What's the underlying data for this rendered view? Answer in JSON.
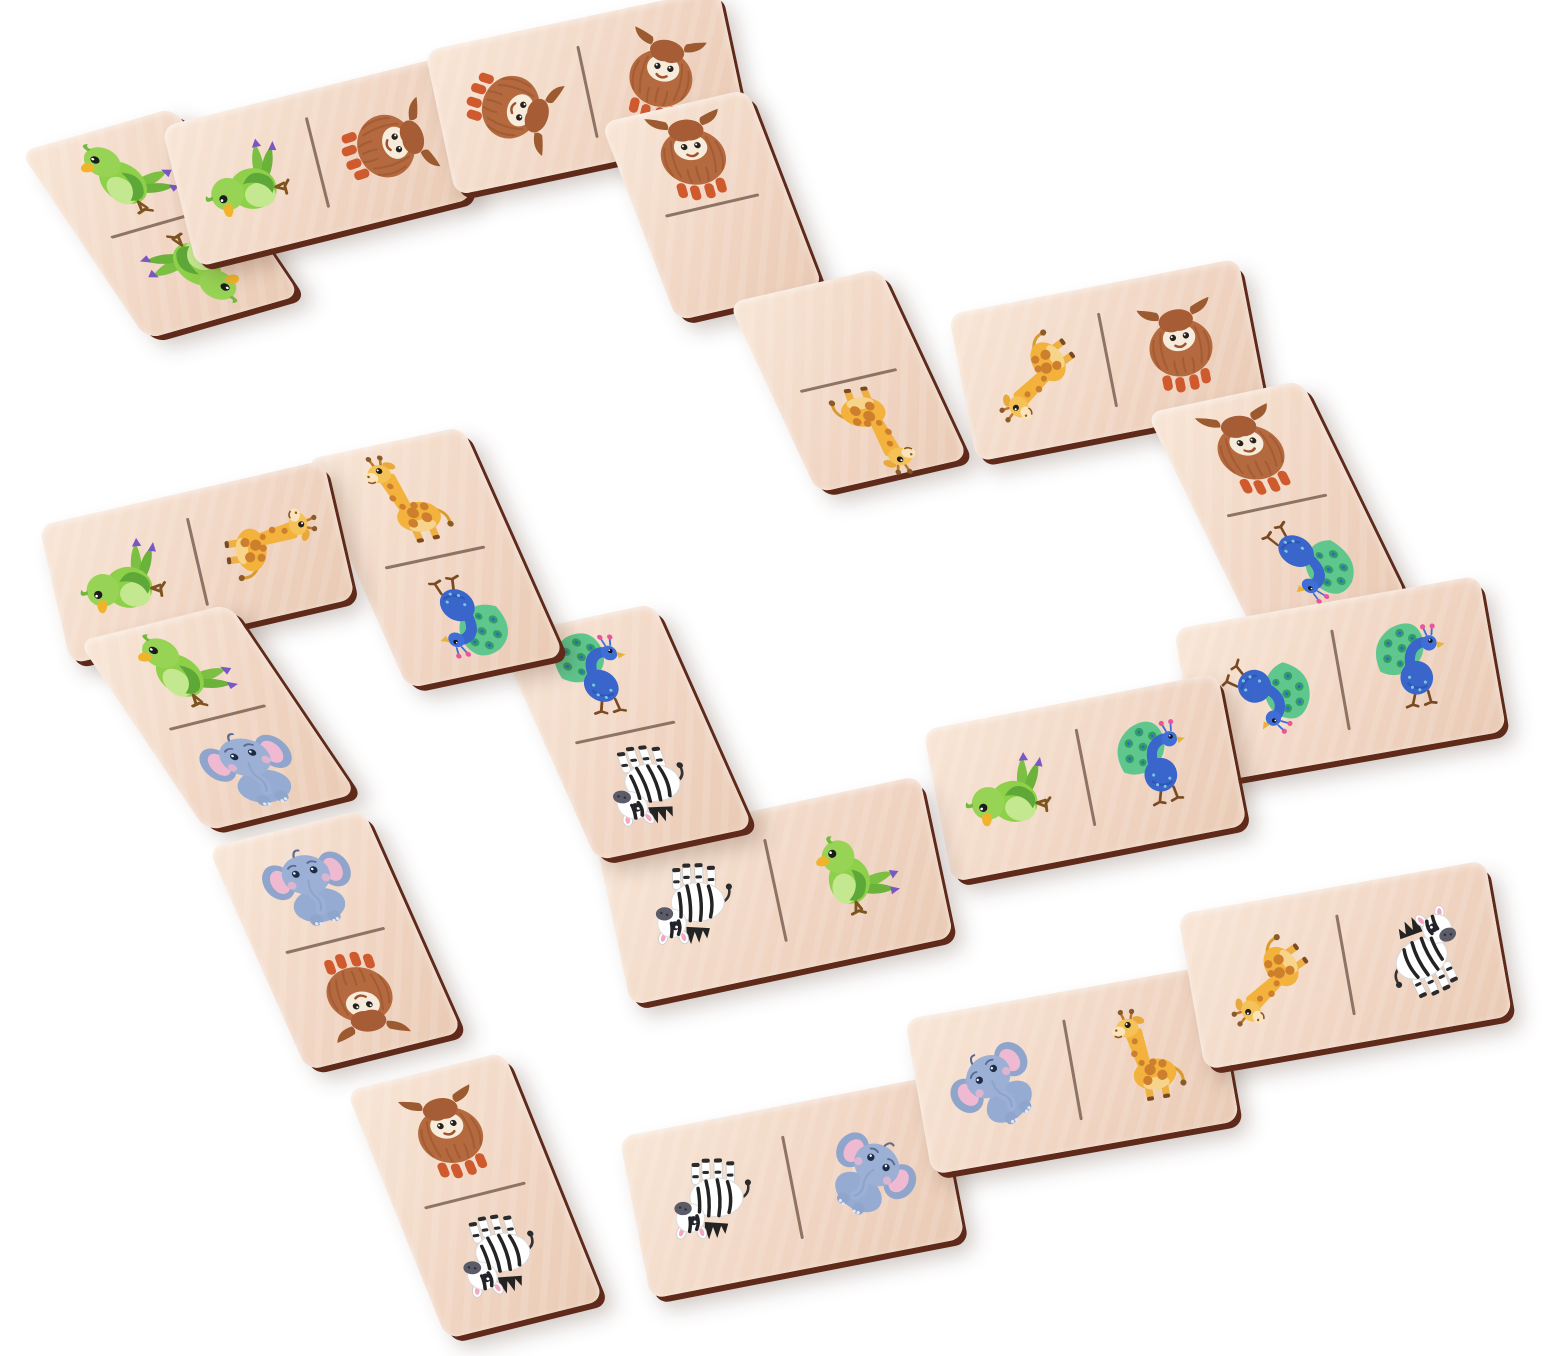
{
  "scene": {
    "subject": "wooden-animal-domino-chain",
    "background_color": "#ffffff",
    "tile_count": 19
  },
  "palette": {
    "bg": "#ffffff",
    "wood_light": "#f8e6d6",
    "wood": "#f1d6c4",
    "wood_shadow": "#e9cab4",
    "edge": "#5f2a1a",
    "divider": "#7d6152",
    "drop_shadow": "rgba(75,42,28,0.25)"
  },
  "animals": {
    "parrot": {
      "label": "Parrot",
      "colors": {
        "body": "#8ed049",
        "wing": "#5ea839",
        "belly": "#c4e88f",
        "beak": "#f0b42c",
        "tail_tip": "#7a58c4"
      }
    },
    "yak": {
      "label": "Yak",
      "colors": {
        "fur": "#b46a3e",
        "fur_dark": "#9a5530",
        "face": "#f7ecdc",
        "horns": "#9c5a30",
        "hooves": "#cf5a2e"
      }
    },
    "giraffe": {
      "label": "Giraffe",
      "colors": {
        "coat": "#f2b23c",
        "patches": "#cd7f2e",
        "muzzle": "#fbe3bb",
        "hooves": "#7a4a22"
      }
    },
    "peacock": {
      "label": "Peacock",
      "colors": {
        "body": "#3a66cc",
        "fan": "#5fc78e",
        "fan_spots": "#2f9f63",
        "crest": "#e8559a",
        "beak": "#e8b33c"
      }
    },
    "zebra": {
      "label": "Zebra",
      "colors": {
        "coat": "#ffffff",
        "stripes": "#232323",
        "muzzle": "#5c5c68",
        "ears": "#f4a8c0"
      }
    },
    "elephant": {
      "label": "Elephant",
      "colors": {
        "body": "#96abd2",
        "head": "#9cb0d6",
        "ear_inner": "#f0b9d2",
        "cheeks": "#edb6cf"
      }
    },
    "blank": {
      "label": "Blank"
    }
  },
  "tiles": [
    {
      "id": 1,
      "orientation": "vertical",
      "cx": 160,
      "cy": 223,
      "w": 160,
      "h": 215,
      "tilt": -16,
      "skew": 18,
      "halves": [
        {
          "animal": "parrot",
          "rotation": 0
        },
        {
          "animal": "parrot",
          "rotation": 180
        }
      ]
    },
    {
      "id": 2,
      "orientation": "horizontal",
      "cx": 317,
      "cy": 162,
      "w": 285,
      "h": 145,
      "tilt": -14,
      "skew": 0,
      "halves": [
        {
          "animal": "parrot",
          "rotation": -75
        },
        {
          "animal": "yak",
          "rotation": 85
        }
      ]
    },
    {
      "id": 3,
      "orientation": "horizontal",
      "cx": 587,
      "cy": 92,
      "w": 300,
      "h": 148,
      "tilt": -12,
      "skew": 0,
      "halves": [
        {
          "animal": "yak",
          "rotation": 120
        },
        {
          "animal": "yak",
          "rotation": 25
        }
      ]
    },
    {
      "id": 4,
      "orientation": "vertical",
      "cx": 712,
      "cy": 205,
      "w": 150,
      "h": 210,
      "tilt": -13,
      "skew": 8,
      "halves": [
        {
          "animal": "yak",
          "rotation": 5
        },
        {
          "animal": "blank",
          "rotation": 0
        }
      ]
    },
    {
      "id": 5,
      "orientation": "vertical",
      "cx": 848,
      "cy": 380,
      "w": 155,
      "h": 205,
      "tilt": -13,
      "skew": 12,
      "halves": [
        {
          "animal": "blank",
          "rotation": 0
        },
        {
          "animal": "giraffe",
          "rotation": 185
        }
      ]
    },
    {
      "id": 6,
      "orientation": "horizontal",
      "cx": 1107,
      "cy": 360,
      "w": 295,
      "h": 150,
      "tilt": -11,
      "skew": 0,
      "halves": [
        {
          "animal": "giraffe",
          "rotation": -115
        },
        {
          "animal": "yak",
          "rotation": 0
        }
      ]
    },
    {
      "id": 7,
      "orientation": "vertical",
      "cx": 1277,
      "cy": 505,
      "w": 158,
      "h": 235,
      "tilt": -12,
      "skew": 14,
      "halves": [
        {
          "animal": "yak",
          "rotation": 0
        },
        {
          "animal": "peacock",
          "rotation": 160
        }
      ]
    },
    {
      "id": 8,
      "orientation": "horizontal",
      "cx": 1340,
      "cy": 680,
      "w": 310,
      "h": 158,
      "tilt": -10,
      "skew": 0,
      "halves": [
        {
          "animal": "peacock",
          "rotation": 135
        },
        {
          "animal": "peacock",
          "rotation": 5
        }
      ]
    },
    {
      "id": 9,
      "orientation": "horizontal",
      "cx": 1085,
      "cy": 777,
      "w": 300,
      "h": 155,
      "tilt": -11,
      "skew": 0,
      "halves": [
        {
          "animal": "parrot",
          "rotation": -70
        },
        {
          "animal": "peacock",
          "rotation": 0
        }
      ]
    },
    {
      "id": 10,
      "orientation": "horizontal",
      "cx": 775,
      "cy": 890,
      "w": 330,
      "h": 165,
      "tilt": -12,
      "skew": 0,
      "halves": [
        {
          "animal": "zebra",
          "rotation": 190
        },
        {
          "animal": "parrot",
          "rotation": 0
        }
      ]
    },
    {
      "id": 11,
      "orientation": "vertical",
      "cx": 625,
      "cy": 732,
      "w": 160,
      "h": 240,
      "tilt": -12,
      "skew": 12,
      "halves": [
        {
          "animal": "peacock",
          "rotation": 10
        },
        {
          "animal": "zebra",
          "rotation": 185
        }
      ]
    },
    {
      "id": 12,
      "orientation": "vertical",
      "cx": 435,
      "cy": 557,
      "w": 160,
      "h": 245,
      "tilt": -12,
      "skew": 12,
      "halves": [
        {
          "animal": "giraffe",
          "rotation": 0
        },
        {
          "animal": "peacock",
          "rotation": 180
        }
      ]
    },
    {
      "id": 13,
      "orientation": "horizontal",
      "cx": 197,
      "cy": 562,
      "w": 292,
      "h": 142,
      "tilt": -13,
      "skew": 0,
      "halves": [
        {
          "animal": "parrot",
          "rotation": -70
        },
        {
          "animal": "giraffe",
          "rotation": 95
        }
      ]
    },
    {
      "id": 14,
      "orientation": "vertical",
      "cx": 217,
      "cy": 717,
      "w": 155,
      "h": 215,
      "tilt": -14,
      "skew": 20,
      "halves": [
        {
          "animal": "parrot",
          "rotation": 5
        },
        {
          "animal": "elephant",
          "rotation": 0
        }
      ]
    },
    {
      "id": 15,
      "orientation": "vertical",
      "cx": 335,
      "cy": 940,
      "w": 160,
      "h": 240,
      "tilt": -14,
      "skew": 10,
      "halves": [
        {
          "animal": "elephant",
          "rotation": 0
        },
        {
          "animal": "yak",
          "rotation": 185
        }
      ]
    },
    {
      "id": 16,
      "orientation": "vertical",
      "cx": 475,
      "cy": 1195,
      "w": 162,
      "h": 265,
      "tilt": -14,
      "skew": 8,
      "halves": [
        {
          "animal": "yak",
          "rotation": 0
        },
        {
          "animal": "zebra",
          "rotation": 185
        }
      ]
    },
    {
      "id": 17,
      "orientation": "horizontal",
      "cx": 792,
      "cy": 1187,
      "w": 320,
      "h": 165,
      "tilt": -11,
      "skew": 0,
      "halves": [
        {
          "animal": "zebra",
          "rotation": 190
        },
        {
          "animal": "elephant",
          "rotation": 45
        }
      ]
    },
    {
      "id": 18,
      "orientation": "horizontal",
      "cx": 1072,
      "cy": 1070,
      "w": 312,
      "h": 158,
      "tilt": -10,
      "skew": 0,
      "halves": [
        {
          "animal": "elephant",
          "rotation": -30
        },
        {
          "animal": "giraffe",
          "rotation": 0
        }
      ]
    },
    {
      "id": 19,
      "orientation": "horizontal",
      "cx": 1345,
      "cy": 965,
      "w": 312,
      "h": 158,
      "tilt": -10,
      "skew": 0,
      "halves": [
        {
          "animal": "giraffe",
          "rotation": -115
        },
        {
          "animal": "zebra",
          "rotation": -15
        }
      ]
    }
  ]
}
